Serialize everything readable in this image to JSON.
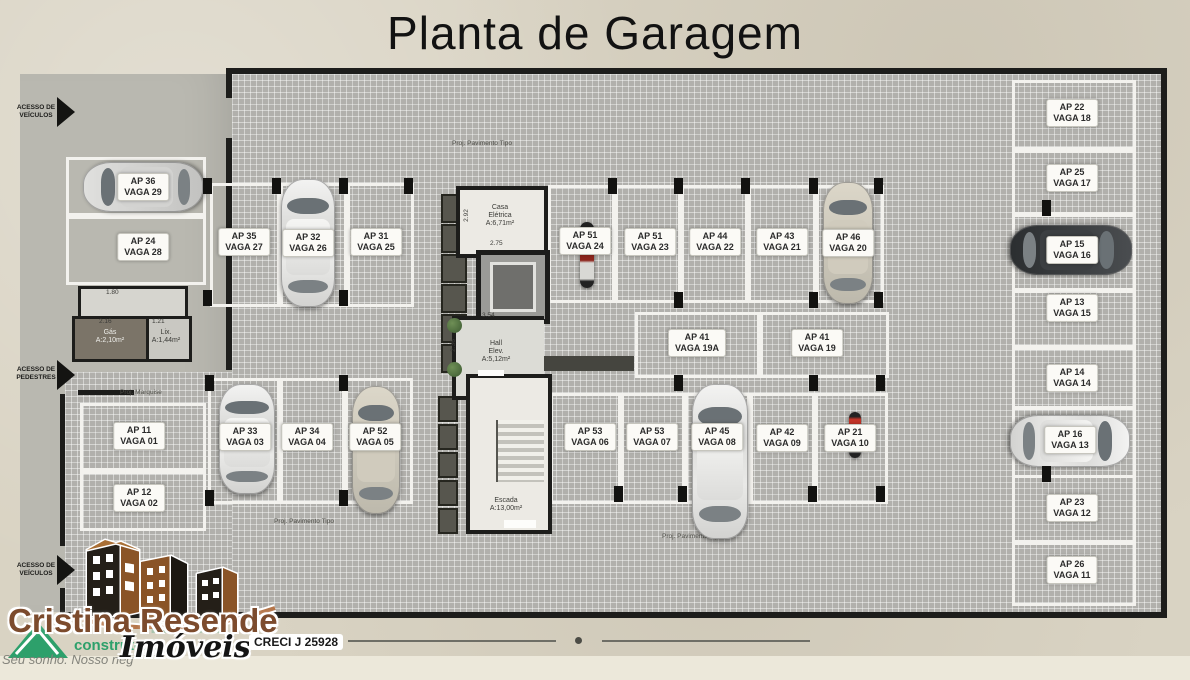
{
  "title": "Planta de Garagem",
  "access": {
    "top_vehicles": {
      "line1": "ACESSO DE",
      "line2": "VEÍCULOS"
    },
    "pedestrians": {
      "line1": "ACESSO DE",
      "line2": "PEDESTRES"
    },
    "bottom_vehicles": {
      "line1": "ACESSO DE",
      "line2": "VEÍCULOS"
    }
  },
  "annotations": {
    "proj_tipo_top": "Proj. Pavimento Tipo",
    "proj_tipo_bottom": "Proj. Pavimento Tipo",
    "proj_tipo_bottom_left": "Proj. Pavimento Tipo",
    "proj_marquise": "Proj. Marquise"
  },
  "dimensions": {
    "d180": "1.80",
    "d216": "2.16",
    "d121": "1.21",
    "d292": "2.92",
    "d275": "2.75",
    "d354": "3.54",
    "d236": "2.36"
  },
  "rooms": {
    "casa_eletrica": {
      "line1": "Casa",
      "line2": "Elétrica",
      "line3": "A:6,71m²"
    },
    "hall": {
      "line1": "Hall",
      "line2": "Elev.",
      "line3": "A:5,12m²"
    },
    "dml": "D.M.L.",
    "escada": {
      "line1": "Escada",
      "line2": "A:13,00m²"
    },
    "gas": {
      "line1": "Gás",
      "line2": "A:2,10m²"
    },
    "lixo": {
      "line1": "Lix.",
      "line2": "A:1,44m²"
    }
  },
  "spots": [
    {
      "ap": "AP 36",
      "vaga": "VAGA 29",
      "vehicle": "car",
      "vehicle_color": "silver"
    },
    {
      "ap": "AP 24",
      "vaga": "VAGA 28",
      "vehicle": null
    },
    {
      "ap": "AP 35",
      "vaga": "VAGA 27",
      "vehicle": null
    },
    {
      "ap": "AP 32",
      "vaga": "VAGA 26",
      "vehicle": "car",
      "vehicle_color": "white"
    },
    {
      "ap": "AP 31",
      "vaga": "VAGA 25",
      "vehicle": null
    },
    {
      "ap": "AP 51",
      "vaga": "VAGA 24",
      "vehicle": "motorcycle",
      "vehicle_color": "red"
    },
    {
      "ap": "AP 51",
      "vaga": "VAGA 23",
      "vehicle": null
    },
    {
      "ap": "AP 44",
      "vaga": "VAGA 22",
      "vehicle": null
    },
    {
      "ap": "AP 43",
      "vaga": "VAGA 21",
      "vehicle": null
    },
    {
      "ap": "AP 46",
      "vaga": "VAGA 20",
      "vehicle": "car",
      "vehicle_color": "beige"
    },
    {
      "ap": "AP 41",
      "vaga": "VAGA 19A",
      "vehicle": null
    },
    {
      "ap": "AP 41",
      "vaga": "VAGA 19",
      "vehicle": null
    },
    {
      "ap": "AP 11",
      "vaga": "VAGA 01",
      "vehicle": null
    },
    {
      "ap": "AP 12",
      "vaga": "VAGA 02",
      "vehicle": null
    },
    {
      "ap": "AP 33",
      "vaga": "VAGA 03",
      "vehicle": "car",
      "vehicle_color": "white"
    },
    {
      "ap": "AP 34",
      "vaga": "VAGA 04",
      "vehicle": null
    },
    {
      "ap": "AP 52",
      "vaga": "VAGA 05",
      "vehicle": "car",
      "vehicle_color": "beige"
    },
    {
      "ap": "AP 53",
      "vaga": "VAGA 06",
      "vehicle": null
    },
    {
      "ap": "AP 53",
      "vaga": "VAGA 07",
      "vehicle": null
    },
    {
      "ap": "AP 45",
      "vaga": "VAGA 08",
      "vehicle": "car",
      "vehicle_color": "white"
    },
    {
      "ap": "AP 42",
      "vaga": "VAGA 09",
      "vehicle": null
    },
    {
      "ap": "AP 21",
      "vaga": "VAGA 10",
      "vehicle": "motorcycle",
      "vehicle_color": "red"
    },
    {
      "ap": "AP 22",
      "vaga": "VAGA 18",
      "vehicle": null
    },
    {
      "ap": "AP 25",
      "vaga": "VAGA 17",
      "vehicle": null
    },
    {
      "ap": "AP 15",
      "vaga": "VAGA 16",
      "vehicle": "car",
      "vehicle_color": "dark-gray"
    },
    {
      "ap": "AP 13",
      "vaga": "VAGA 15",
      "vehicle": null
    },
    {
      "ap": "AP 14",
      "vaga": "VAGA 14",
      "vehicle": null
    },
    {
      "ap": "AP 16",
      "vaga": "VAGA 13",
      "vehicle": "car",
      "vehicle_color": "white"
    },
    {
      "ap": "AP 23",
      "vaga": "VAGA 12",
      "vehicle": null
    },
    {
      "ap": "AP 26",
      "vaga": "VAGA 11",
      "vehicle": null
    }
  ],
  "footer_logo": {
    "brand_line1": "Cristina Resende",
    "brand_line2": "Imóveis",
    "creci": "CRECI J 25928",
    "watermark_construtora": "construtora",
    "watermark_tagline": "Seu sonho. Nosso neg",
    "watermark_fragment": "IDADE",
    "colors": {
      "brand_brown": "#7c4b2d",
      "green": "#2da06b"
    }
  },
  "colors": {
    "wall": "#1d1d1b",
    "grid_base": "#b1b0ac",
    "page": "#d9d3c3",
    "spot_line": "#f3f2ee"
  }
}
